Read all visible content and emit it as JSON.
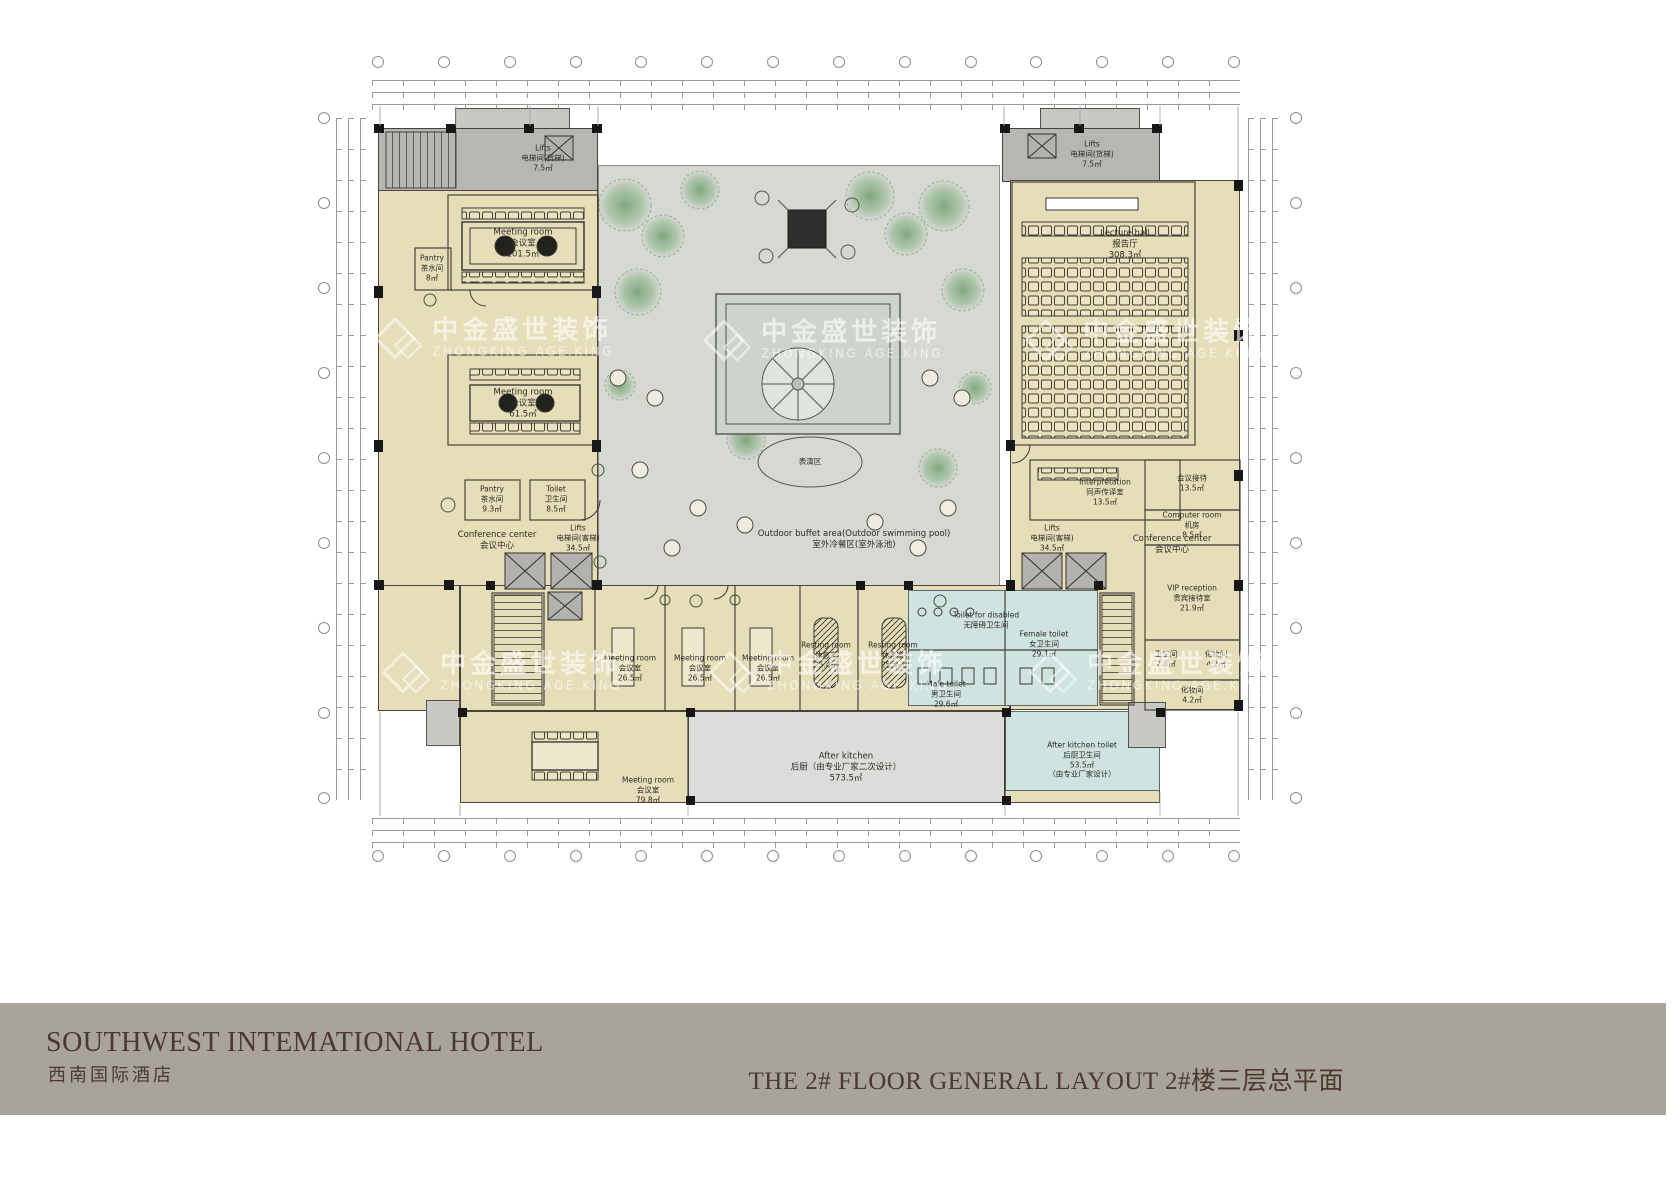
{
  "colors": {
    "footer_bar": "#a8a39b",
    "title_text": "#4b382e",
    "room_beige": "#e6ddb9",
    "corridor_gray": "#b7b6b2",
    "courtyard_gray": "#d5d9d2",
    "toilet_blue": "#cfe3e0",
    "kitchen_gray": "#dcdcda",
    "tree_green": "#7fa87c"
  },
  "footer": {
    "hotel_name_en": "SOUTHWEST INTEMATIONAL HOTEL",
    "hotel_name_cn": "西南国际酒店",
    "drawing_title": "THE 2# FLOOR GENERAL LAYOUT  2#楼三层总平面"
  },
  "watermark": {
    "cn": "中金盛世装饰",
    "en": "ZHONGKING AGE.KING"
  },
  "courtyard": {
    "buffet_en": "Outdoor buffet area(Outdoor swimming pool)",
    "buffet_cn": "室外冷餐区(室外泳池)",
    "performance_cn": "表演区"
  },
  "rooms": {
    "meeting_large": {
      "en": "Meeting room",
      "cn": "会议室",
      "area": "101.5㎡"
    },
    "pantry_top": {
      "en": "Pantry",
      "cn": "茶水间",
      "area": "8㎡"
    },
    "lifts_freight": {
      "en": "Lifts",
      "cn": "电梯间(货梯)",
      "area": "7.5㎡"
    },
    "meeting_mid": {
      "en": "Meeting room",
      "cn": "会议室",
      "area": "61.5㎡"
    },
    "pantry_mid": {
      "en": "Pantry",
      "cn": "茶水间",
      "area": "9.3㎡"
    },
    "toilet_left": {
      "en": "Toilet",
      "cn": "卫生间",
      "area": "8.5㎡"
    },
    "conference_center": {
      "en": "Conference center",
      "cn": "会议中心"
    },
    "lifts_passenger": {
      "en": "Lifts",
      "cn": "电梯间(客梯)",
      "area": "34.5㎡"
    },
    "lecture_hall": {
      "en": "Lecture hall",
      "cn": "报告厅",
      "area": "308.3㎡"
    },
    "interpretation": {
      "en": "Interpretation",
      "cn": "同声传译室",
      "area": "13.5㎡"
    },
    "reception": {
      "en": "Conference reception",
      "cn": "会议接待",
      "area": "13.5㎡"
    },
    "computer": {
      "en": "Computer room",
      "cn": "机房",
      "area": "8.5㎡"
    },
    "vip": {
      "en": "VIP reception",
      "cn": "贵宾接待室",
      "area": "21.9㎡"
    },
    "toilet_small": {
      "en": "Toilet",
      "cn": "卫生间",
      "area": "2.5㎡"
    },
    "dressing": {
      "en": "Dressing",
      "cn": "化妆间",
      "area": "4.2㎡"
    },
    "meeting_small": {
      "en": "Meeting room",
      "cn": "会议室",
      "area": "26.5㎡"
    },
    "resting": {
      "en": "Resting room",
      "cn": "休息室",
      "area": "25.4㎡"
    },
    "male_toilet": {
      "en": "Male toilet",
      "cn": "男卫生间",
      "area": "29.6㎡"
    },
    "female_toilet": {
      "en": "Female toilet",
      "cn": "女卫生间",
      "area": "29.1㎡"
    },
    "accessible_toilet": {
      "en": "Toilet for disabled",
      "cn": "无障碍卫生间"
    },
    "meeting_79": {
      "en": "Meeting room",
      "cn": "会议室",
      "area": "79.8㎡"
    },
    "after_kitchen": {
      "en": "After kitchen",
      "cn": "后厨（由专业厂家二次设计）",
      "area": "573.5㎡"
    },
    "kitchen_toilet": {
      "en": "After kitchen toilet",
      "cn": "后厨卫生间",
      "area": "53.5㎡",
      "note": "（由专业厂家设计）"
    }
  }
}
